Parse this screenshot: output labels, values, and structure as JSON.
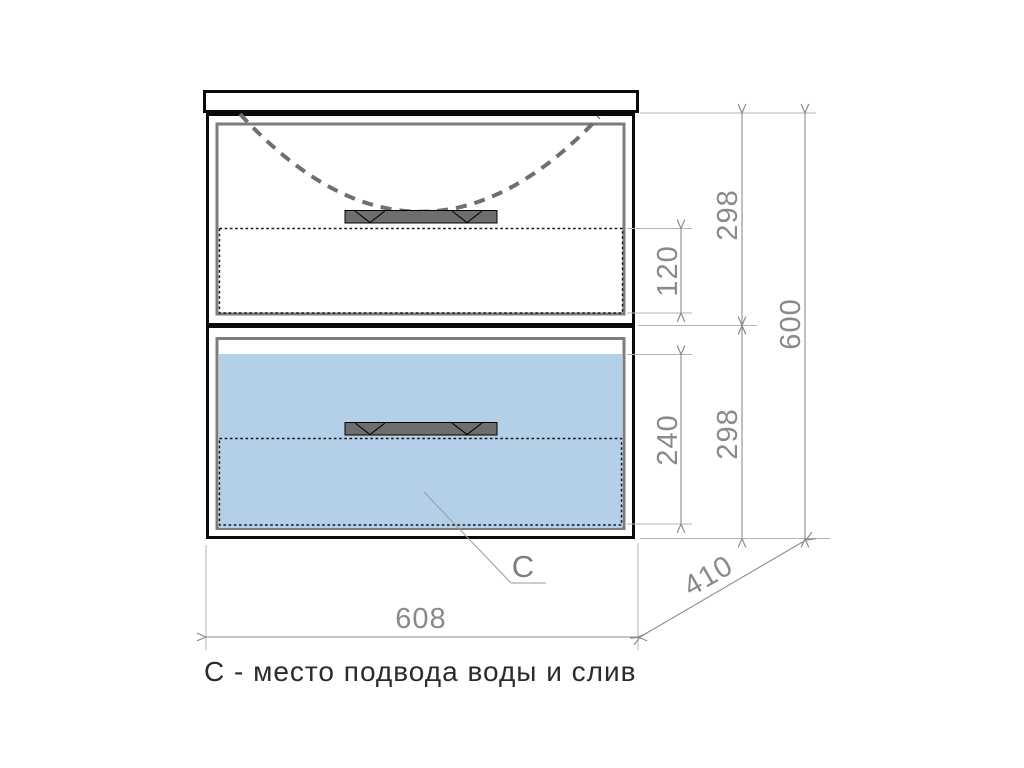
{
  "cabinet": {
    "c_label": "C",
    "caption": "С - место подвода воды и слив"
  },
  "dimensions": {
    "width": "608",
    "depth": "410",
    "height_total": "600",
    "top_drawer_height": "298",
    "bottom_drawer_height": "298",
    "top_drawer_inner": "120",
    "bottom_drawer_inner": "240"
  },
  "colors": {
    "outline_black": "#0a0a0a",
    "frame_gray": "#7d7d7d",
    "handle_gray": "#6e6e6e",
    "sink_outline_gray": "#6f6f6f",
    "water_zone_blue": "#b4d0e9",
    "dimension_gray": "#8a8a8a",
    "extension_gray": "#b3b3b3",
    "caption_dark": "#2b2b2b"
  }
}
